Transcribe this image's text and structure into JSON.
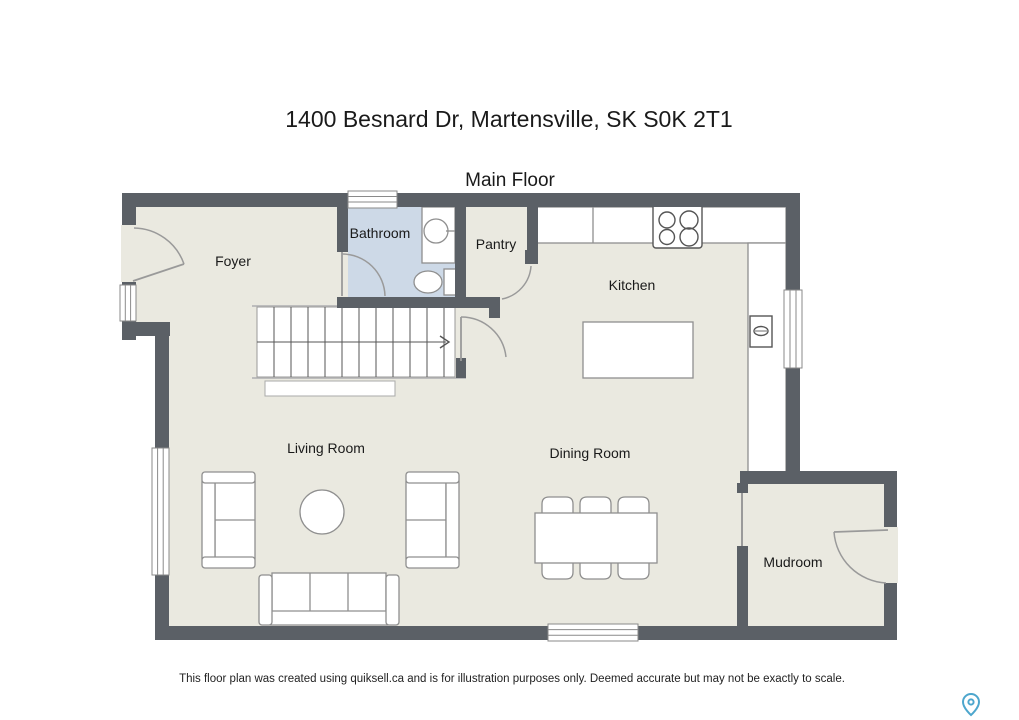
{
  "header": {
    "title": "1400 Besnard Dr, Martensville, SK S0K 2T1",
    "floor_label": "Main Floor"
  },
  "rooms": {
    "foyer": "Foyer",
    "bathroom": "Bathroom",
    "pantry": "Pantry",
    "kitchen": "Kitchen",
    "living_room": "Living Room",
    "dining_room": "Dining Room",
    "mudroom": "Mudroom"
  },
  "footer": {
    "disclaimer": "This floor plan was created using quiksell.ca and is for illustration purposes only. Deemed accurate but may not be exactly to scale."
  },
  "icons": {
    "map_pin": "map-pin"
  },
  "colors": {
    "wall": "#5b6066",
    "floor": "#eae9e0",
    "bathroom_floor": "#cdd9e7",
    "fixture_stroke": "#8f8f8f",
    "stair_stroke": "#555555",
    "door_stroke": "#9a9a9a",
    "pin": "#4da6cd",
    "text": "#1a1a1a"
  }
}
